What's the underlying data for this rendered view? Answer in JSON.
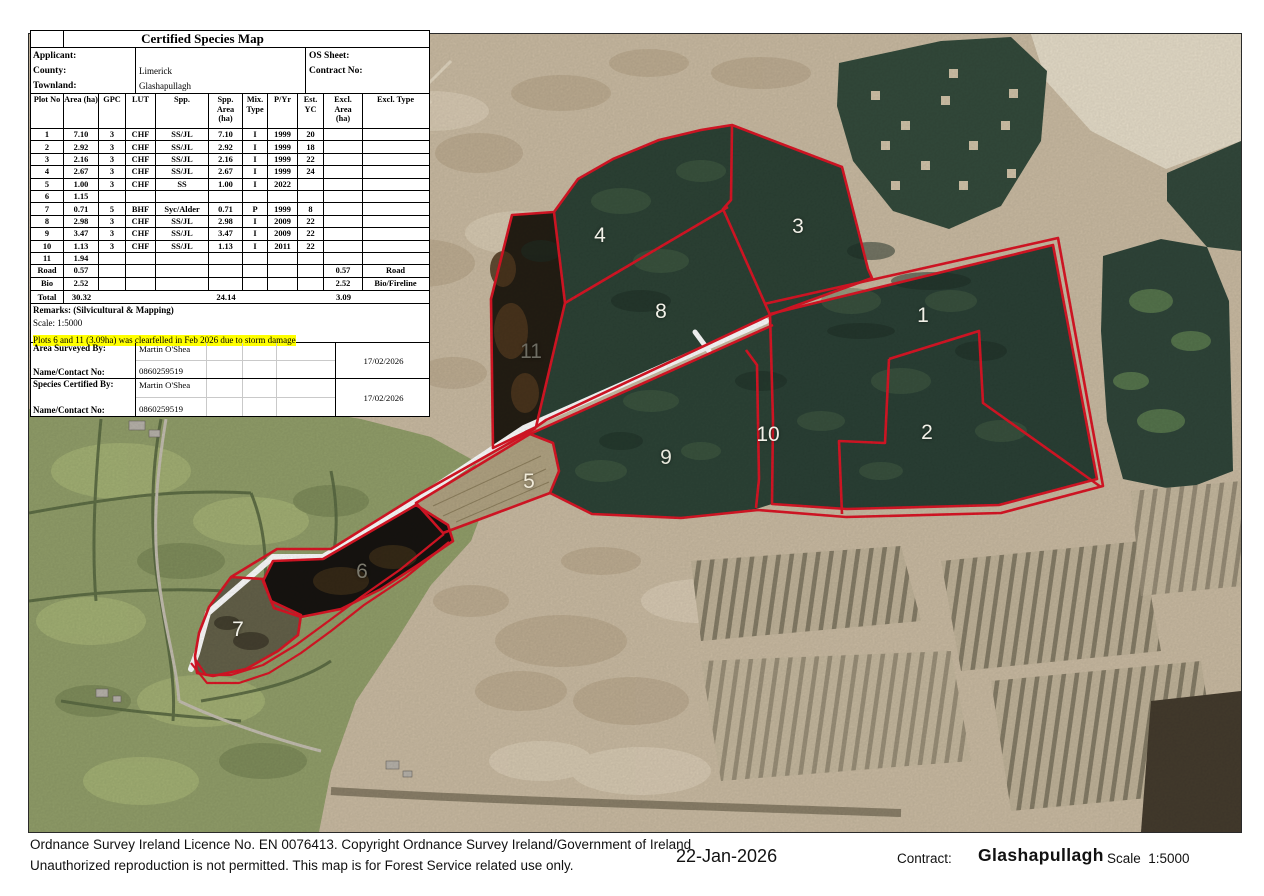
{
  "table": {
    "title": "Certified Species Map",
    "info": {
      "applicant_label": "Applicant:",
      "applicant_value": "",
      "county_label": "County:",
      "county_value": "Limerick",
      "townland_label": "Townland:",
      "townland_value": "Glashapullagh",
      "os_sheet_label": "OS Sheet:",
      "contract_no_label": "Contract No:"
    },
    "columns": [
      "Plot No",
      "Area (ha)",
      "GPC",
      "LUT",
      "Spp.",
      "Spp. Area\n(ha)",
      "Mix.\nType",
      "P/Yr",
      "Est. YC",
      "Excl.\nArea\n(ha)",
      "Excl. Type"
    ],
    "rows": [
      [
        "1",
        "7.10",
        "3",
        "CHF",
        "SS/JL",
        "7.10",
        "I",
        "1999",
        "20",
        "",
        ""
      ],
      [
        "2",
        "2.92",
        "3",
        "CHF",
        "SS/JL",
        "2.92",
        "I",
        "1999",
        "18",
        "",
        ""
      ],
      [
        "3",
        "2.16",
        "3",
        "CHF",
        "SS/JL",
        "2.16",
        "I",
        "1999",
        "22",
        "",
        ""
      ],
      [
        "4",
        "2.67",
        "3",
        "CHF",
        "SS/JL",
        "2.67",
        "I",
        "1999",
        "24",
        "",
        ""
      ],
      [
        "5",
        "1.00",
        "3",
        "CHF",
        "SS",
        "1.00",
        "I",
        "2022",
        "",
        "",
        ""
      ],
      [
        "6",
        "1.15",
        "",
        "",
        "",
        "",
        "",
        "",
        "",
        "",
        ""
      ],
      [
        "7",
        "0.71",
        "5",
        "BHF",
        "Syc/Alder",
        "0.71",
        "P",
        "1999",
        "8",
        "",
        ""
      ],
      [
        "8",
        "2.98",
        "3",
        "CHF",
        "SS/JL",
        "2.98",
        "I",
        "2009",
        "22",
        "",
        ""
      ],
      [
        "9",
        "3.47",
        "3",
        "CHF",
        "SS/JL",
        "3.47",
        "I",
        "2009",
        "22",
        "",
        ""
      ],
      [
        "10",
        "1.13",
        "3",
        "CHF",
        "SS/JL",
        "1.13",
        "I",
        "2011",
        "22",
        "",
        ""
      ],
      [
        "11",
        "1.94",
        "",
        "",
        "",
        "",
        "",
        "",
        "",
        "",
        ""
      ],
      [
        "Road",
        "0.57",
        "",
        "",
        "",
        "",
        "",
        "",
        "",
        "0.57",
        "Road"
      ],
      [
        "Bio",
        "2.52",
        "",
        "",
        "",
        "",
        "",
        "",
        "",
        "2.52",
        "Bio/Fireline"
      ]
    ],
    "total": {
      "label": "Total",
      "area": "30.32",
      "spp_area": "24.14",
      "excl_area": "3.09"
    },
    "remarks_label": "Remarks: (Silvicultural & Mapping)",
    "scale_line": "Scale: 1:5000",
    "highlight_note": "Plots 6 and 11 (3.09ha) was clearfelled in Feb 2026 due to storm damage",
    "surveyed": {
      "label1": "Area Surveyed By:",
      "label2": "Name/Contact No:",
      "name": "Martin O'Shea",
      "phone": "0860259519",
      "date": "17/02/2026"
    },
    "certified": {
      "label1": "Species Certified By:",
      "label2": "Name/Contact No:",
      "name": "Martin O'Shea",
      "phone": "0860259519",
      "date": "17/02/2026"
    }
  },
  "map": {
    "plot_labels": [
      {
        "text": "4",
        "x": 600,
        "y": 236,
        "color": "#f2f1e8"
      },
      {
        "text": "3",
        "x": 798,
        "y": 227,
        "color": "#f2f1e8"
      },
      {
        "text": "8",
        "x": 661,
        "y": 312,
        "color": "#f2f1e8"
      },
      {
        "text": "11",
        "x": 531,
        "y": 352,
        "color": "#6e6d63"
      },
      {
        "text": "1",
        "x": 923,
        "y": 316,
        "color": "#f2f1e8"
      },
      {
        "text": "10",
        "x": 768,
        "y": 435,
        "color": "#f2f1e8"
      },
      {
        "text": "2",
        "x": 927,
        "y": 433,
        "color": "#f2f1e8"
      },
      {
        "text": "9",
        "x": 666,
        "y": 458,
        "color": "#e8e8dc"
      },
      {
        "text": "5",
        "x": 529,
        "y": 482,
        "color": "#f0ead8"
      },
      {
        "text": "6",
        "x": 362,
        "y": 572,
        "color": "#7b796d"
      },
      {
        "text": "7",
        "x": 238,
        "y": 630,
        "color": "#f2f1e8"
      }
    ],
    "boundary_color": "#dd1626",
    "road_color": "#ffffff"
  },
  "footer": {
    "line1": "Ordnance Survey Ireland Licence No. EN 0076413. Copyright Ordnance Survey Ireland/Government of Ireland",
    "line2": "Unauthorized reproduction is not permitted. This map is for Forest Service related use only.",
    "date": "22-Jan-2026",
    "contract_label": "Contract:",
    "contract_value": "Glashapullagh",
    "scale_text": "Scale  1:5000"
  }
}
